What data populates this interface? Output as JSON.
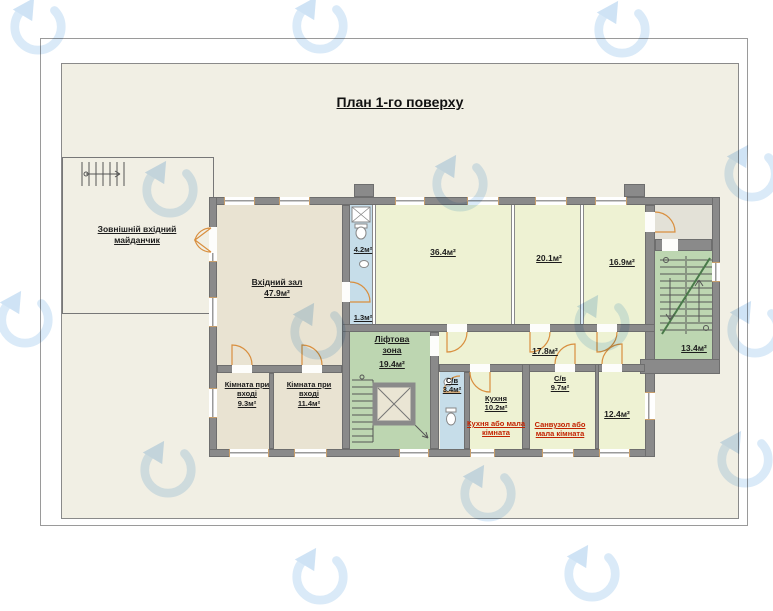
{
  "title": "План 1-го поверху",
  "rooms": {
    "platform": {
      "label": "Зовнішній вхідний майданчик"
    },
    "hall": {
      "label": "Вхідний зал",
      "area": "47.9м²"
    },
    "bath_top": {
      "area": "4.2м²"
    },
    "bath_top_sm": {
      "area": "1.3м²"
    },
    "room_364": {
      "area": "36.4м²"
    },
    "room_201": {
      "area": "20.1м²"
    },
    "room_169": {
      "area": "16.9м²"
    },
    "lift_zone": {
      "label": "Ліфтова зона",
      "area": "19.4м²"
    },
    "corridor": {
      "area": "17.8м²"
    },
    "stair_hall": {
      "area": "13.4м²"
    },
    "entry_room_1": {
      "label": "Кімната при вході",
      "area": "9.3м²"
    },
    "entry_room_2": {
      "label": "Кімната при вході",
      "area": "11.4м²"
    },
    "bath_34": {
      "label": "С/в",
      "area": "3.4м²"
    },
    "kitchen": {
      "label": "Кухня",
      "area": "10.2м²",
      "note": "Кухня або мала кімната"
    },
    "bath_97": {
      "label": "С/в",
      "area": "9.7м²",
      "note": "Санвузол або мала кімната"
    },
    "room_124": {
      "area": "12.4м²"
    }
  },
  "colors": {
    "wall": "#8a8a8a",
    "room_beige": "#e9e3d2",
    "room_lime": "#eef2d3",
    "zone_green": "#bdd6b1",
    "wet_blue": "#c6dde9",
    "vestibule_gray": "#e3e1d7",
    "sheet_bg": "#f1efe4",
    "door_orange": "#d98f3f",
    "note_red": "#c32200",
    "watermark_blue": "#bcd9f2"
  },
  "icons": {
    "watermark": "watermark-logo-icon",
    "stairs": "stairs-icon",
    "elevator": "elevator-icon",
    "toilet": "toilet-icon",
    "shower": "shower-icon",
    "sink": "sink-icon"
  }
}
